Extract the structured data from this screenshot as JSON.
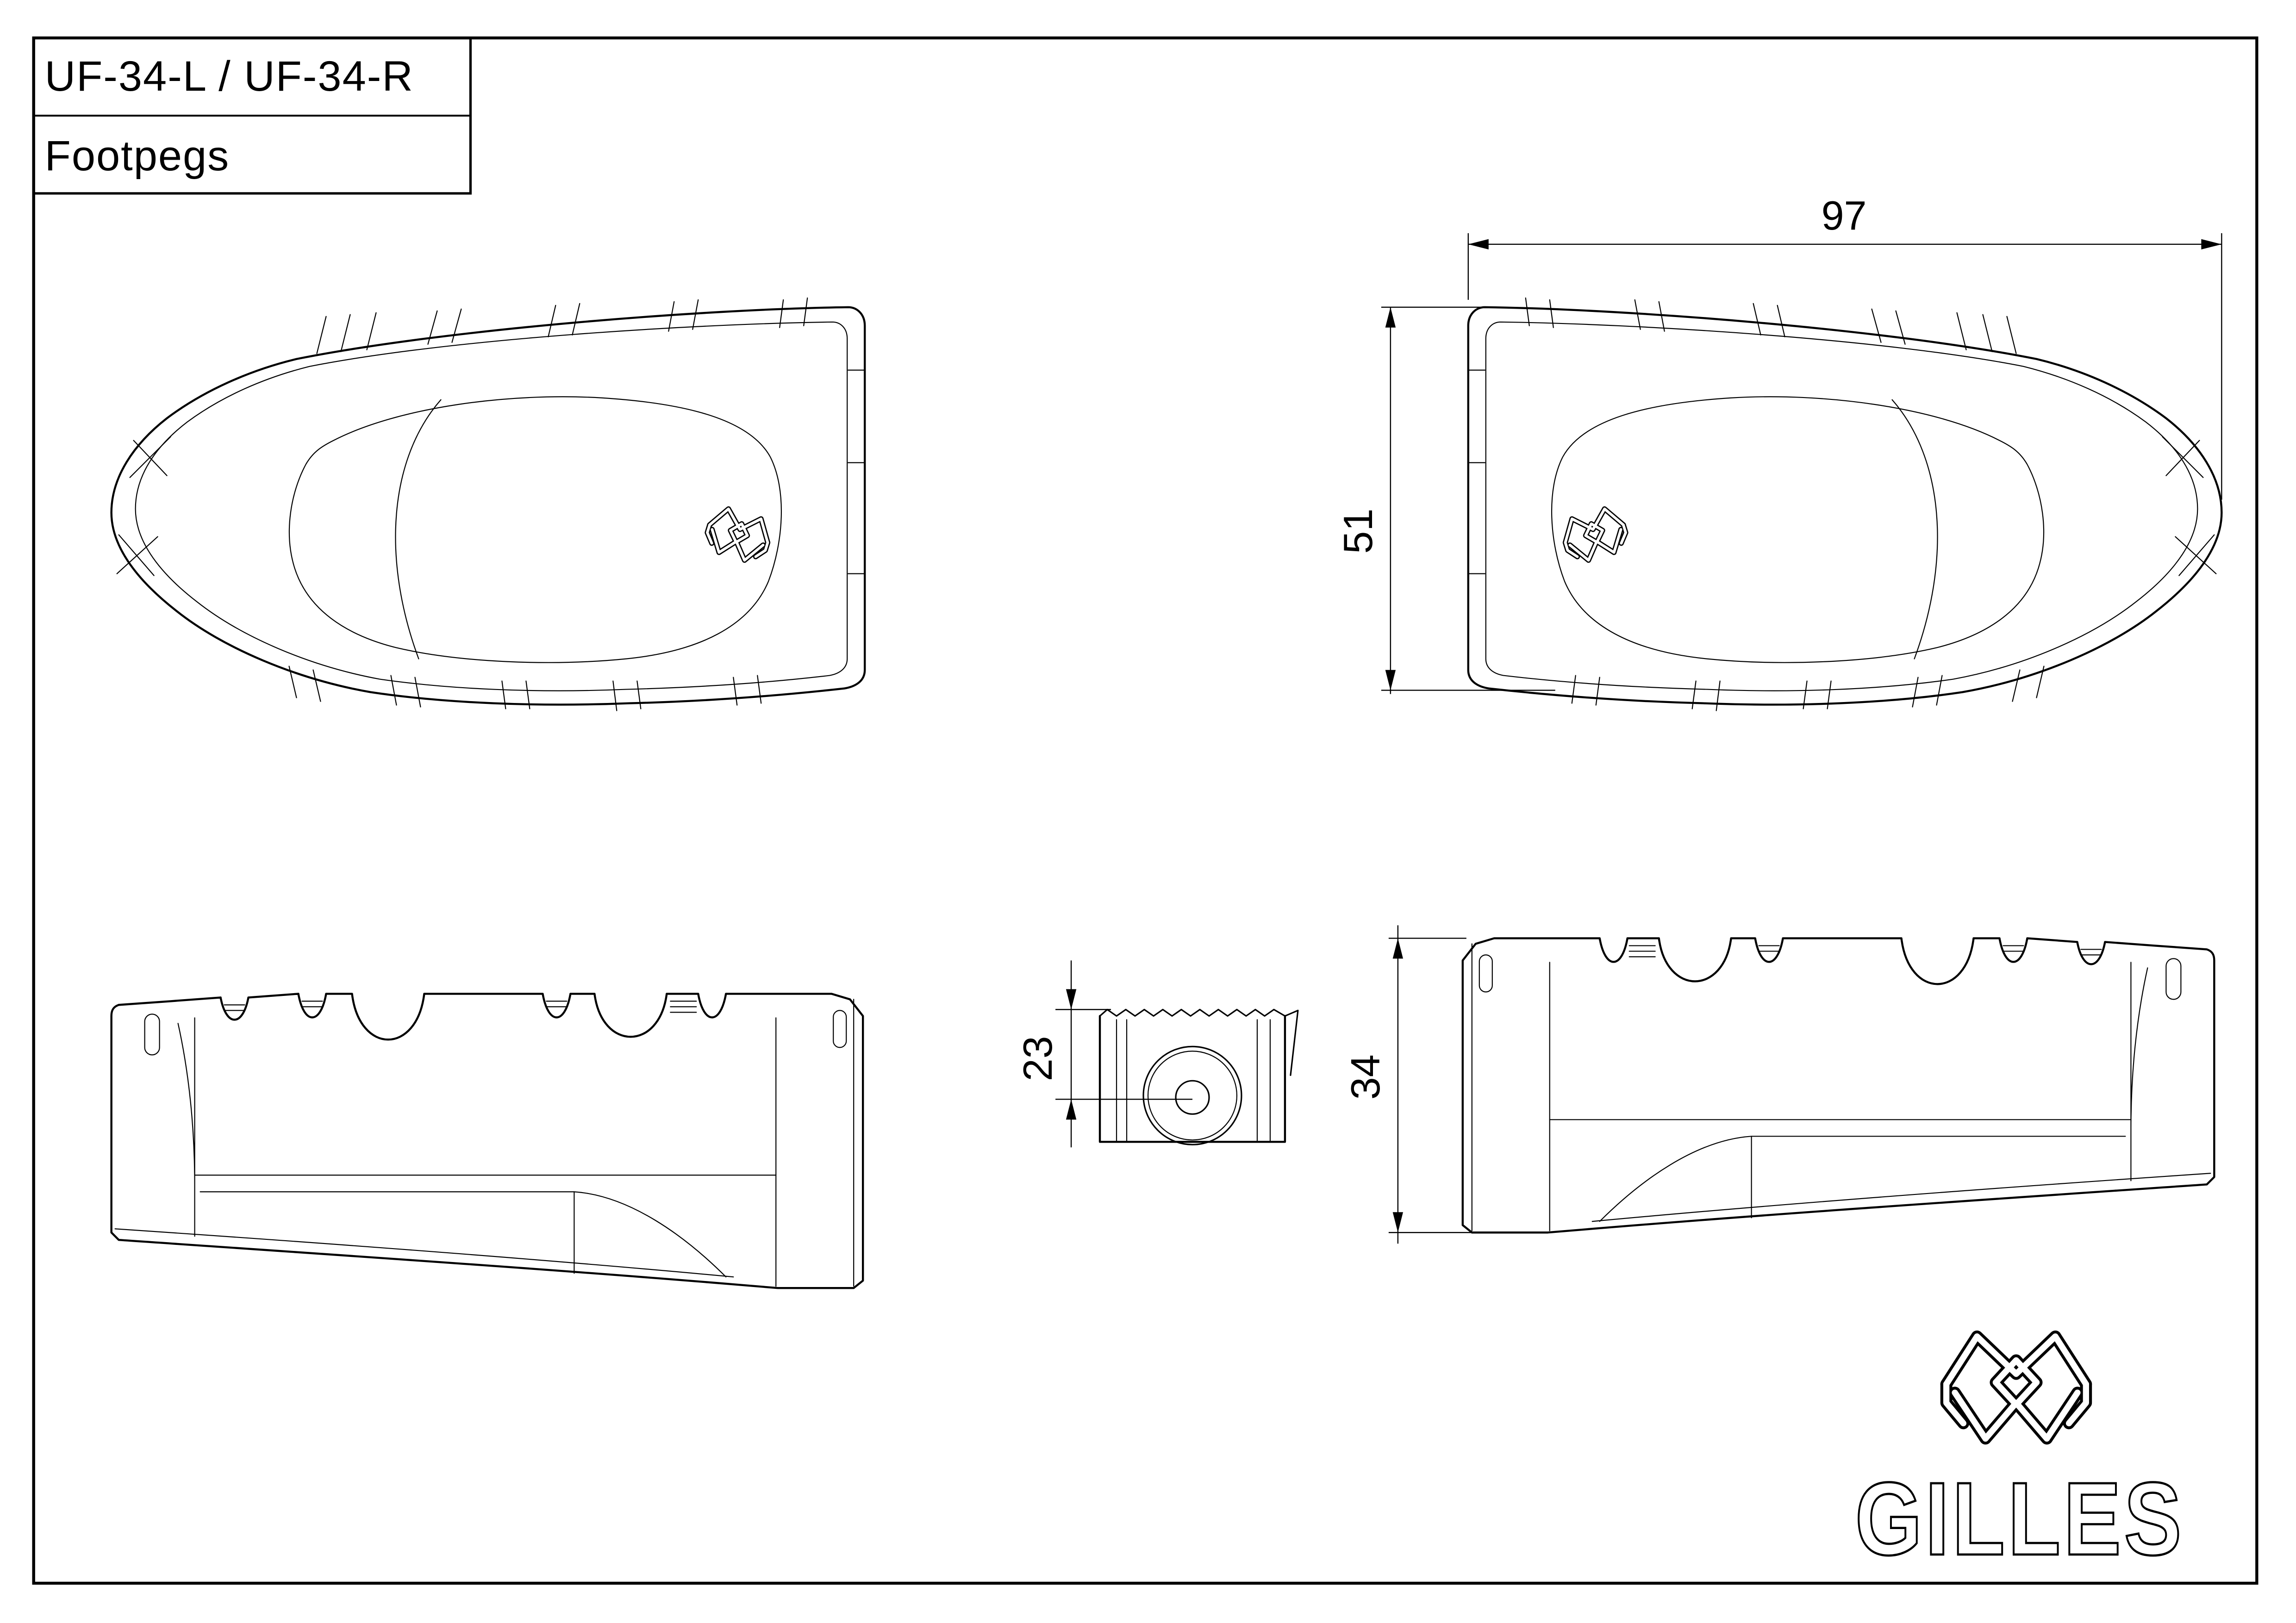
{
  "title_block": {
    "part_number": "UF-34-L / UF-34-R",
    "part_name": "Footpegs"
  },
  "dimensions": {
    "overall_length": "97",
    "overall_width": "51",
    "mount_center_height": "23",
    "side_height": "34"
  },
  "brand": {
    "name": "GILLES",
    "emblem": "gilles-knot-icon"
  },
  "colors": {
    "line": "#000000",
    "background": "#ffffff"
  }
}
